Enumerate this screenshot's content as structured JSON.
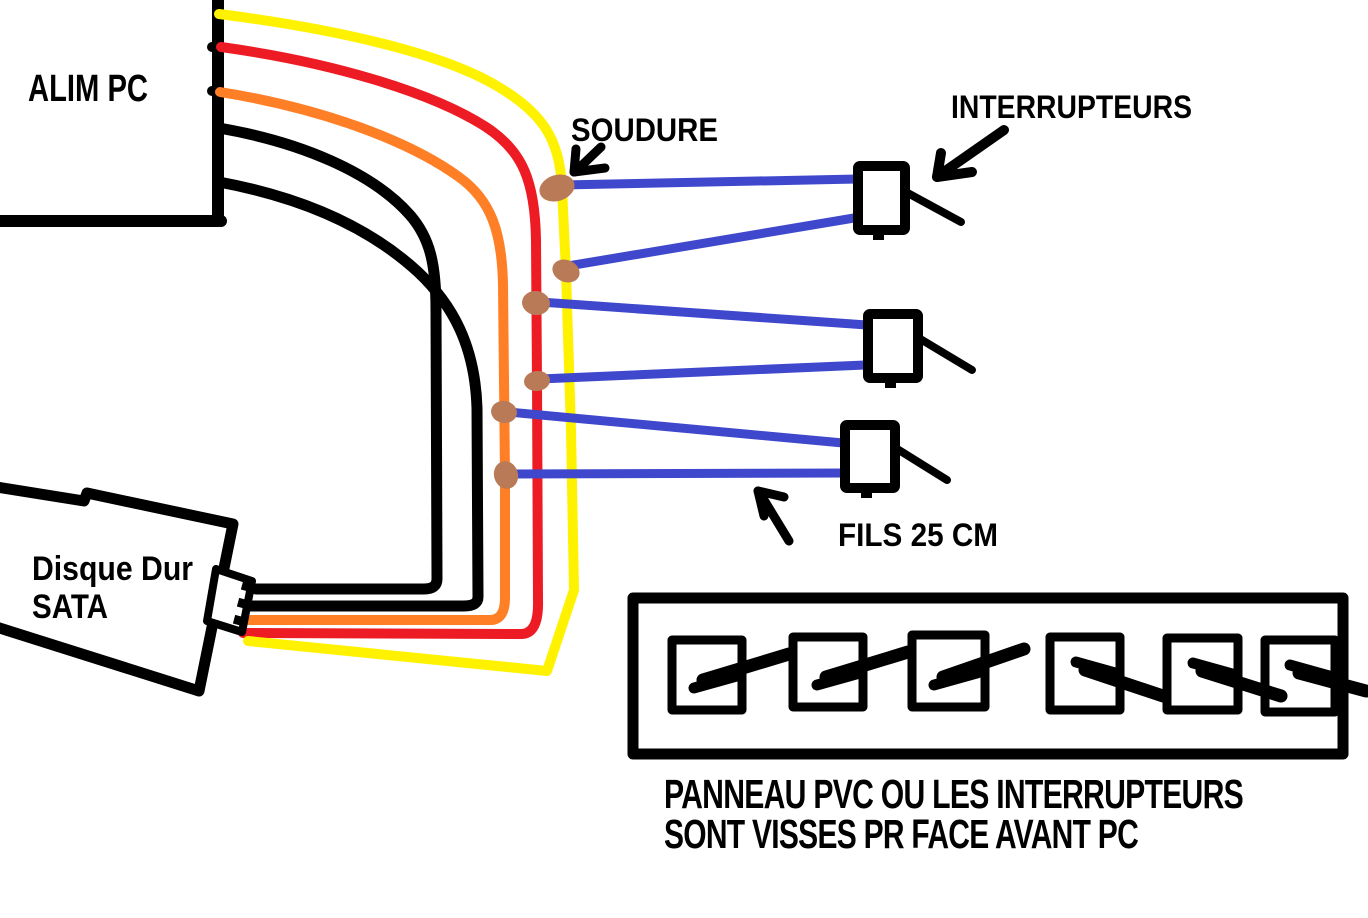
{
  "canvas": {
    "width": 1368,
    "height": 918,
    "background": "#ffffff"
  },
  "labels": {
    "alim_pc": "ALIM PC",
    "disque_dur_line1": "Disque Dur",
    "disque_dur_line2": "SATA",
    "soudure": "SOUDURE",
    "interrupteurs": "INTERRUPTEURS",
    "fils": "FILS 25 CM",
    "panneau_line1": "PANNEAU PVC OU LES INTERRUPTEURS",
    "panneau_line2": "SONT VISSES PR FACE AVANT PC"
  },
  "colors": {
    "yellow": "#FFF200",
    "red": "#ED1C24",
    "orange": "#FF7F27",
    "black": "#000000",
    "blue": "#3F48CC",
    "solder": "#B97A57"
  },
  "components": {
    "psu_wire_colors": [
      "yellow",
      "red",
      "orange",
      "black",
      "black"
    ],
    "solder_point_count": 6,
    "blue_wire_count": 6,
    "switch_count": 3,
    "panel_switch_count": 6
  }
}
